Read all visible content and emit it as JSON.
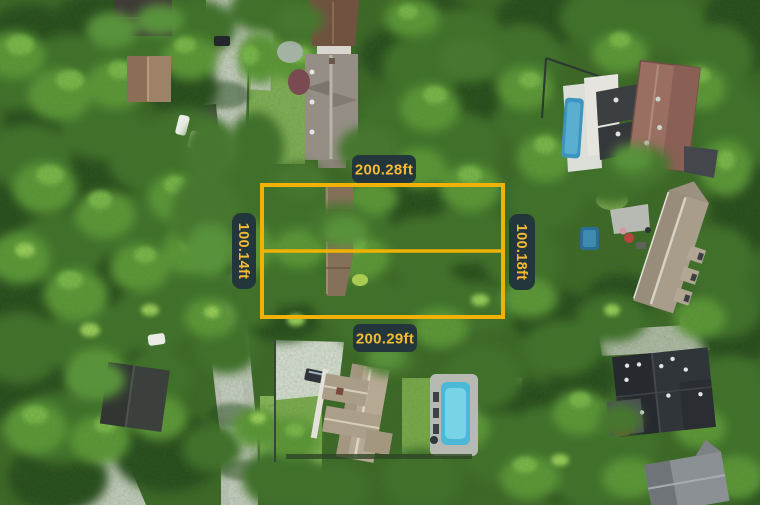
{
  "annotation": {
    "top_label": "200.28ft",
    "bottom_label": "200.29ft",
    "left_label": "100.14ft",
    "right_label": "100.18ft",
    "colors": {
      "boundary": "#F2B105",
      "badge_bg": "#22363C",
      "badge_text": "#F5BB33"
    }
  }
}
